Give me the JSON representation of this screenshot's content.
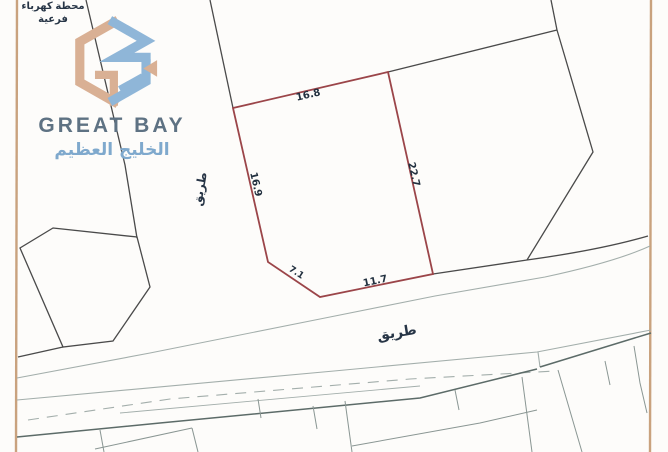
{
  "brand": {
    "name_en": "GREAT BAY",
    "name_ar": "الخليج العظيم",
    "logo_colors": {
      "tan": "#d9b094",
      "blue": "#8fb6d8",
      "text_en": "#5e7283",
      "text_ar": "#7fa9cd"
    }
  },
  "map": {
    "highlighted_parcel": {
      "outline_color": "#9b4549",
      "measurements": {
        "top": "16.8",
        "right": "22.7",
        "left": "16.9",
        "bottom_diagonal": "7.1",
        "bottom": "11.7"
      }
    },
    "labels": {
      "road_horizontal": "طريق",
      "road_vertical": "طريق",
      "substation_line1": "محطة كهرباء",
      "substation_line2": "فرعية"
    },
    "colors": {
      "page_border": "#c9a27e",
      "parcel_line": "#4a4a4a",
      "road_line": "#a3aeab",
      "road_line_dark": "#5c6b68",
      "label_text": "#22303f",
      "background": "#fdfcfa"
    }
  }
}
